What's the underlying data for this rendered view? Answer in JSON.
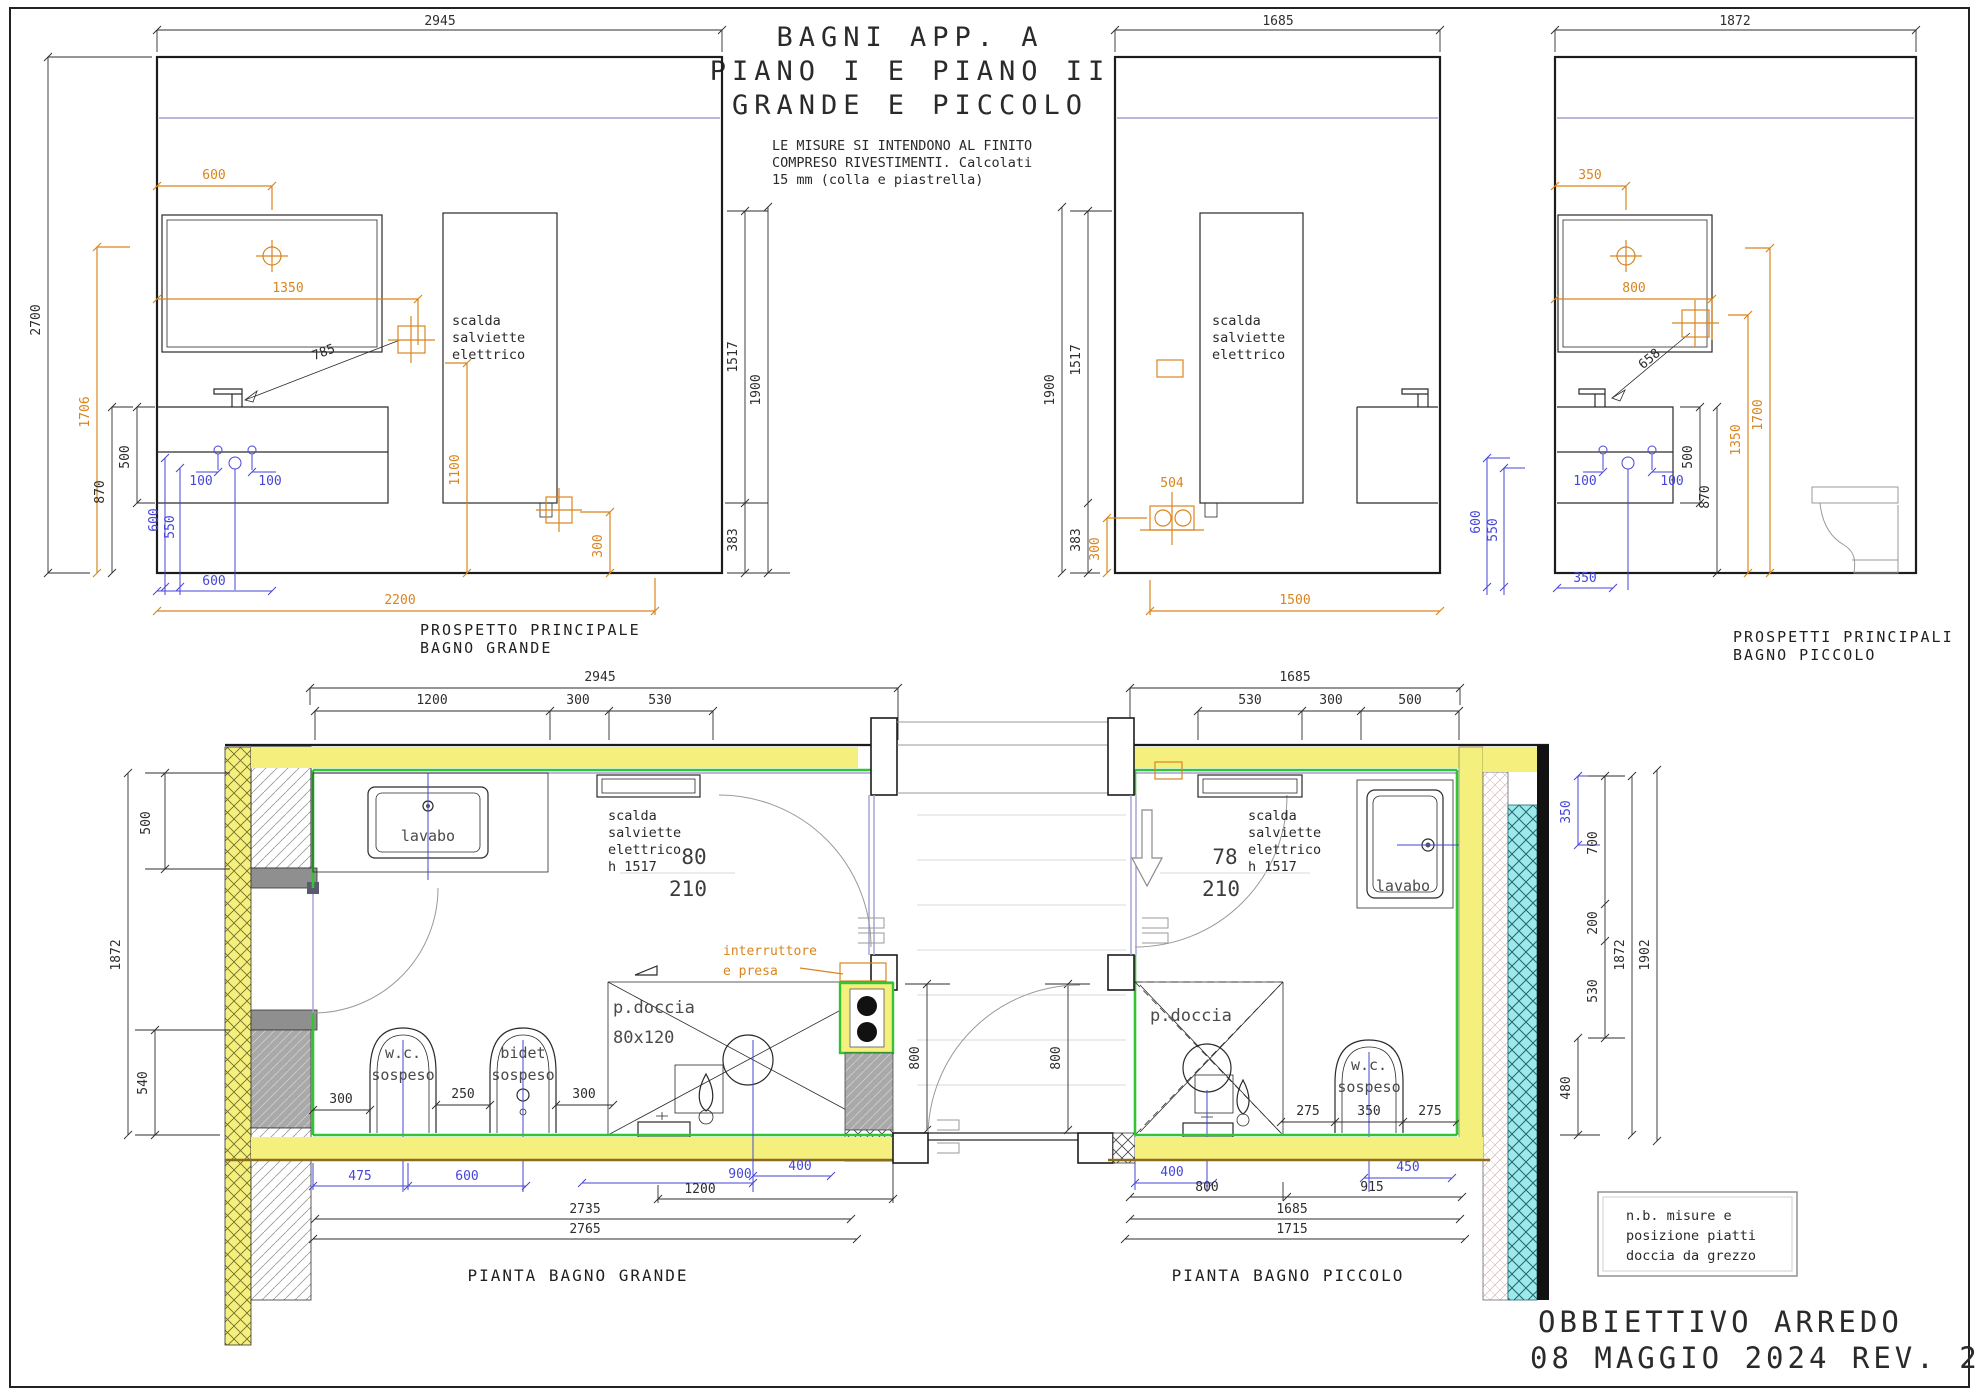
{
  "sheet": {
    "title1": "BAGNI APP. A",
    "title2": "PIANO I E PIANO II",
    "title3": "GRANDE E PICCOLO",
    "note1": "LE MISURE SI INTENDONO AL FINITO",
    "note2": "COMPRESO RIVESTIMENTI. Calcolati",
    "note3": "15 mm (colla e piastrella)"
  },
  "titleblock": {
    "line1": "OBBIETTIVO ARREDO",
    "line2": "08 MAGGIO 2024 REV. 2"
  },
  "nb": {
    "l1": "n.b. misure e",
    "l2": "posizione piatti",
    "l3": "doccia da grezzo"
  },
  "lbl": {
    "sc1": "scalda",
    "sc2": "salviette",
    "sc3": "elettrico",
    "h1517": "h 1517",
    "lavabo": "lavabo",
    "wc": "w.c.",
    "sosp": "sospeso",
    "bidet": "bidet",
    "pd": "p.doccia",
    "pds": "80x120",
    "int1": "interruttore",
    "int2": "e presa"
  },
  "eg": {
    "w": "2945",
    "h": "2700",
    "m600": "600",
    "m1350": "1350",
    "v1706": "1706",
    "b500": "500",
    "b870": "870",
    "l785": "785",
    "v1100": "1100",
    "o300": "300",
    "b2200": "2200",
    "bl100a": "100",
    "bl100b": "100",
    "blv600": "600",
    "blv550": "550",
    "blb600": "600",
    "r1517": "1517",
    "r1900": "1900",
    "r383": "383",
    "cap1": "PROSPETTO PRINCIPALE",
    "cap2": "BAGNO GRANDE"
  },
  "em": {
    "w": "1685",
    "l1900": "1900",
    "l1517": "1517",
    "l383": "383",
    "o300": "300",
    "s504": "504",
    "b1500": "1500",
    "blv600": "600",
    "blv550": "550"
  },
  "ep": {
    "w": "1872",
    "m350": "350",
    "m800": "800",
    "l658": "658",
    "v1700": "1700",
    "v1350": "1350",
    "b500": "500",
    "b870": "870",
    "bl100a": "100",
    "bl100b": "100",
    "blb350": "350",
    "cap1": "PROSPETTI PRINCIPALI",
    "cap2": "BAGNO PICCOLO"
  },
  "pg": {
    "t2945": "2945",
    "t1200": "1200",
    "t300": "300",
    "t530": "530",
    "l500": "500",
    "l1872": "1872",
    "l540": "540",
    "d80": "80",
    "d210": "210",
    "i300a": "300",
    "i250": "250",
    "i300b": "300",
    "bl475": "475",
    "bl600": "600",
    "bl900": "900",
    "bl400": "400",
    "b1200": "1200",
    "b2735": "2735",
    "b2765": "2765",
    "cap": "PIANTA BAGNO GRANDE"
  },
  "pp": {
    "t1685": "1685",
    "t530": "530",
    "t300": "300",
    "t500": "500",
    "d78": "78",
    "d210": "210",
    "i275a": "275",
    "i350": "350",
    "i275b": "275",
    "bl400": "400",
    "bl450": "450",
    "b800": "800",
    "b915": "915",
    "b1685": "1685",
    "b1715": "1715",
    "r350": "350",
    "r700": "700",
    "r200": "200",
    "r530": "530",
    "r480": "480",
    "r1872": "1872",
    "r1902": "1902",
    "cap": "PIANTA BAGNO PICCOLO"
  },
  "hall": {
    "a800": "800",
    "b800": "800"
  }
}
